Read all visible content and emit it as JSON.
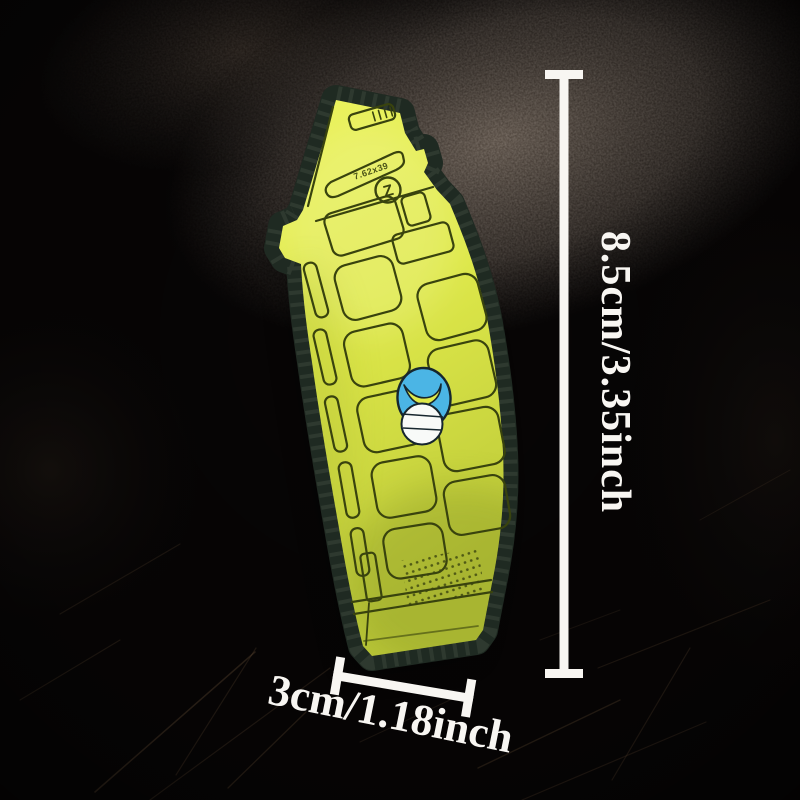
{
  "scene": {
    "description": "Product photo of a yellow AK-47 magazine shaped PVC rubber morale patch lying on a dark scratched leather surface, with white size dimension annotations",
    "background": {
      "base_color": "#070505",
      "glow_color": "#564a40",
      "scratch_color": "#8a6a48"
    }
  },
  "patch": {
    "name": "AK-47 magazine PVC patch",
    "body_color": "#dfe94a",
    "body_color_light": "#ecf35e",
    "body_color_dark": "#bcc938",
    "detail_line_color": "#39430e",
    "border_color": "#1f2a22",
    "stitch_color": "#4a5647",
    "markings": {
      "caliber": "7.62x39",
      "logo": "Z"
    },
    "mascot": {
      "head_color": "#4bb5e5",
      "face_color": "#f8faf8",
      "outline_color": "#16262e"
    }
  },
  "dimensions": {
    "color": "#f8f6f2",
    "height_label": "8.5cm/3.35inch",
    "width_label": "3cm/1.18inch"
  }
}
